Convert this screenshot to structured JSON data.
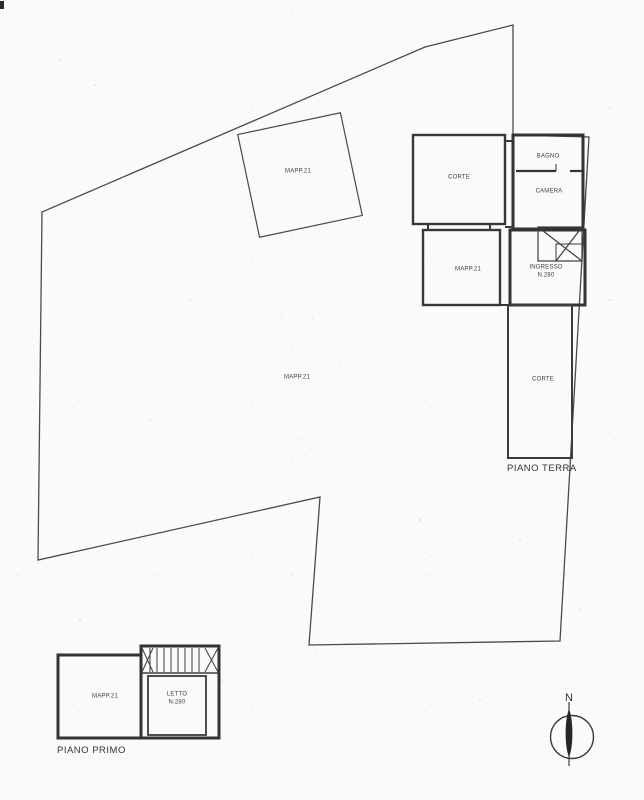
{
  "labels": {
    "mapp_square": "MAPP.21",
    "corte_upper": "CORTE",
    "bagno": "BAGNO",
    "camera": "CAMERA",
    "mapp_ground": "MAPP.21",
    "ingresso": "INGRESSO",
    "ingresso_num": "N.280",
    "mapp_parcel": "MAPP.21",
    "corte_right": "CORTE",
    "piano_terra": "PIANO TERRA",
    "mapp_first": "MAPP.21",
    "letto": "LETTO",
    "letto_num": "N.280",
    "piano_primo": "PIANO PRIMO",
    "north": "N"
  },
  "colors": {
    "ink": "#3a3a3a",
    "paper": "#fafaf8"
  }
}
